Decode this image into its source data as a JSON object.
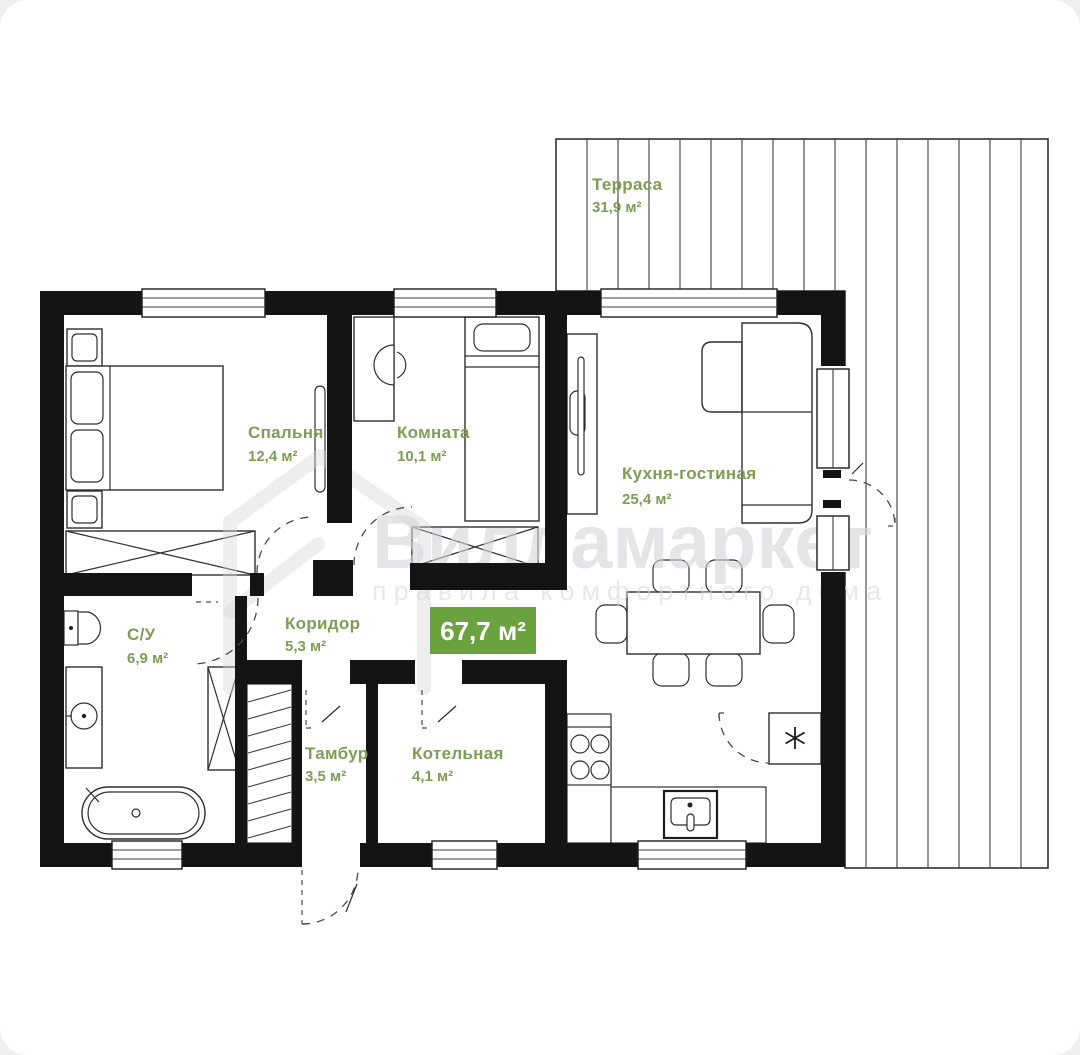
{
  "plan": {
    "total_area": "67,7 м²",
    "rooms": [
      {
        "name": "Терраса",
        "area": "31,9 м²"
      },
      {
        "name": "Спальня",
        "area": "12,4 м²"
      },
      {
        "name": "Комната",
        "area": "10,1 м²"
      },
      {
        "name": "Кухня-гостиная",
        "area": "25,4 м²"
      },
      {
        "name": "С/У",
        "area": "6,9 м²"
      },
      {
        "name": "Коридор",
        "area": "5,3 м²"
      },
      {
        "name": "Тамбур",
        "area": "3,5 м²"
      },
      {
        "name": "Котельная",
        "area": "4,1 м²"
      }
    ],
    "watermark": {
      "brand": "Вилламаркет",
      "tagline": "правила комфортного дома"
    },
    "colors": {
      "label_green": "#7d9e54",
      "badge_green": "#6aa23d",
      "wall_black": "#141414",
      "watermark_gray": "#d6d6d9"
    }
  }
}
